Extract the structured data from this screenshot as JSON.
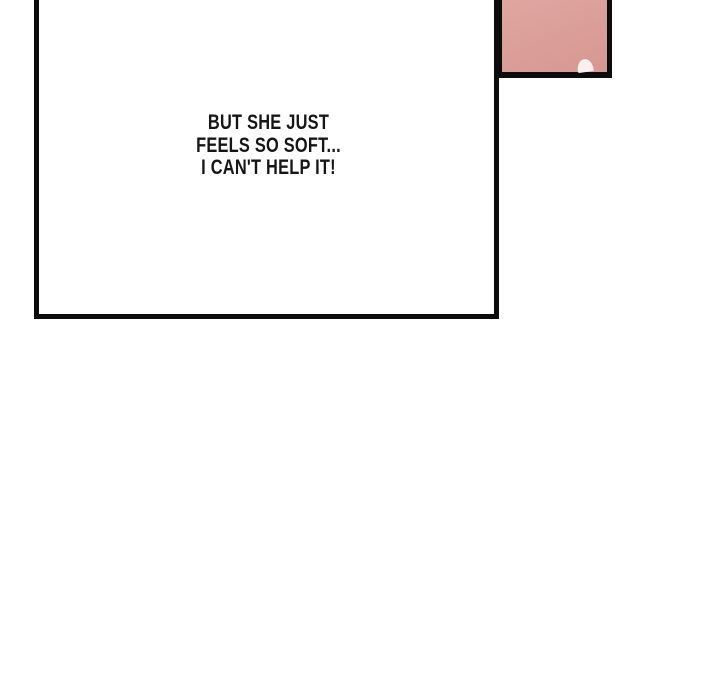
{
  "page": {
    "type": "webtoon-comic-page"
  },
  "speech_bubble": {
    "lines": [
      "BUT SHE JUST",
      "FEELS SO SOFT...",
      "I CAN'T HELP IT!"
    ]
  },
  "corner_panel": {
    "description": "pink artwork panel fragment with small light highlight shape"
  },
  "colors": {
    "page_background": "#ffffff",
    "panel_border": "#0c0c0c",
    "panel_background": "#ffffff",
    "pink_top": "#e0a7a1",
    "pink_bottom": "#d69792",
    "highlight": "#faf0ed",
    "speech_text": "#161616"
  }
}
